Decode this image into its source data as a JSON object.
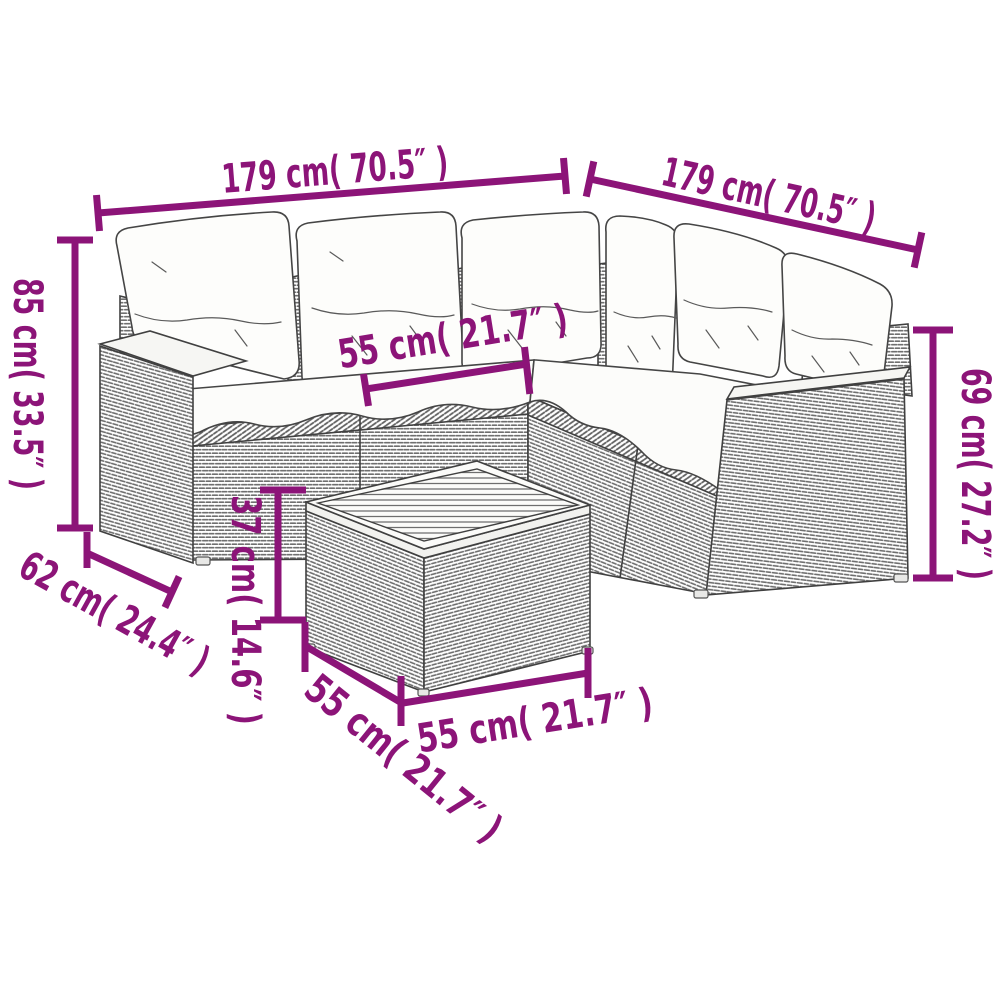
{
  "page": {
    "background": "#ffffff",
    "accent_color": "#8c1478",
    "line_art_color": "#404040"
  },
  "diagram": {
    "type": "product-dimension-diagram",
    "subject": "L-shaped poly rattan garden sofa set with white cushions and square coffee table",
    "dimensions": {
      "sofa_width_left": {
        "label": "179 cm( 70.5″ )"
      },
      "sofa_width_right": {
        "label": "179 cm( 70.5″ )"
      },
      "back_height": {
        "label": "85 cm( 33.5″ )"
      },
      "arm_height": {
        "label": "69 cm( 27.2″ )"
      },
      "seat_width": {
        "label": "55 cm( 21.7″ )"
      },
      "seat_depth": {
        "label": "62 cm( 24.4″ )"
      },
      "table_height": {
        "label": "37 cm( 14.6″ )"
      },
      "table_depth": {
        "label": "55 cm( 21.7″ )"
      },
      "table_width": {
        "label": "55 cm( 21.7″ )"
      }
    }
  }
}
